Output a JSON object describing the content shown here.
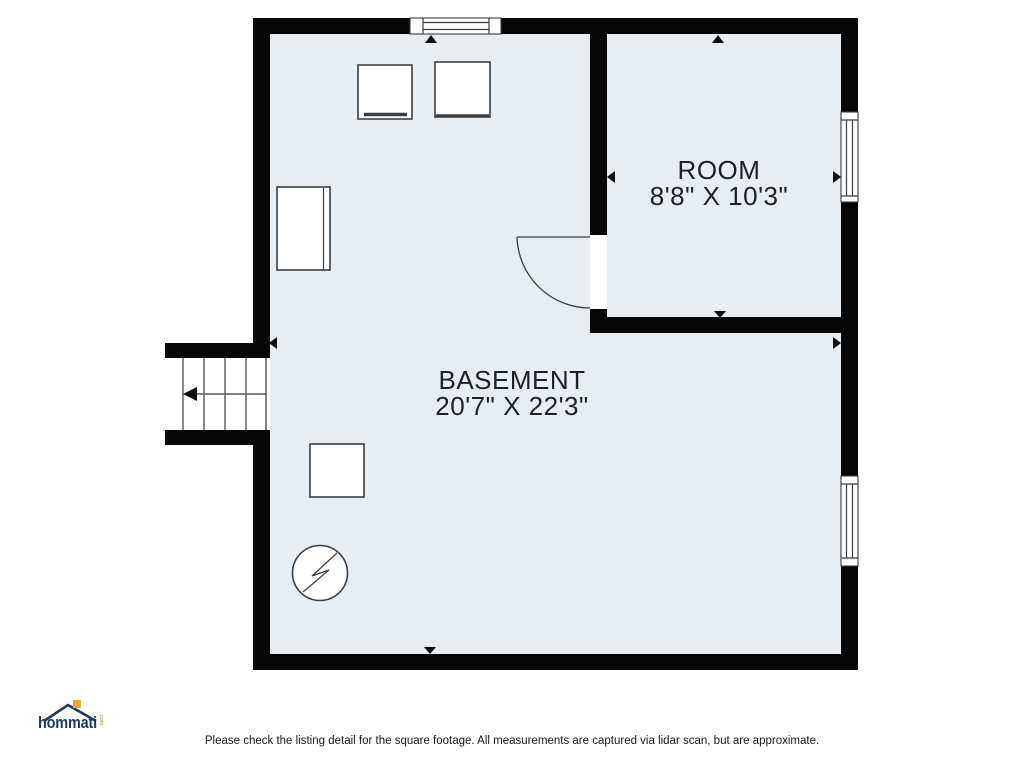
{
  "plan": {
    "rooms": [
      {
        "name": "BASEMENT",
        "dimensions": "20'7\" X 22'3\""
      },
      {
        "name": "ROOM",
        "dimensions": "8'8\" X 10'3\""
      }
    ]
  },
  "colors": {
    "floor": "#e8edf1",
    "wall": "#060606",
    "label": "#1d2126",
    "furniture_stroke": "#3a3f44",
    "logo_navy": "#1e3a5c",
    "logo_orange": "#f2a92e"
  },
  "footer": {
    "logo_text": "hommati",
    "logo_suffix": "com",
    "disclaimer": "Please check the listing detail for the square footage. All measurements are captured via lidar scan, but are approximate."
  }
}
